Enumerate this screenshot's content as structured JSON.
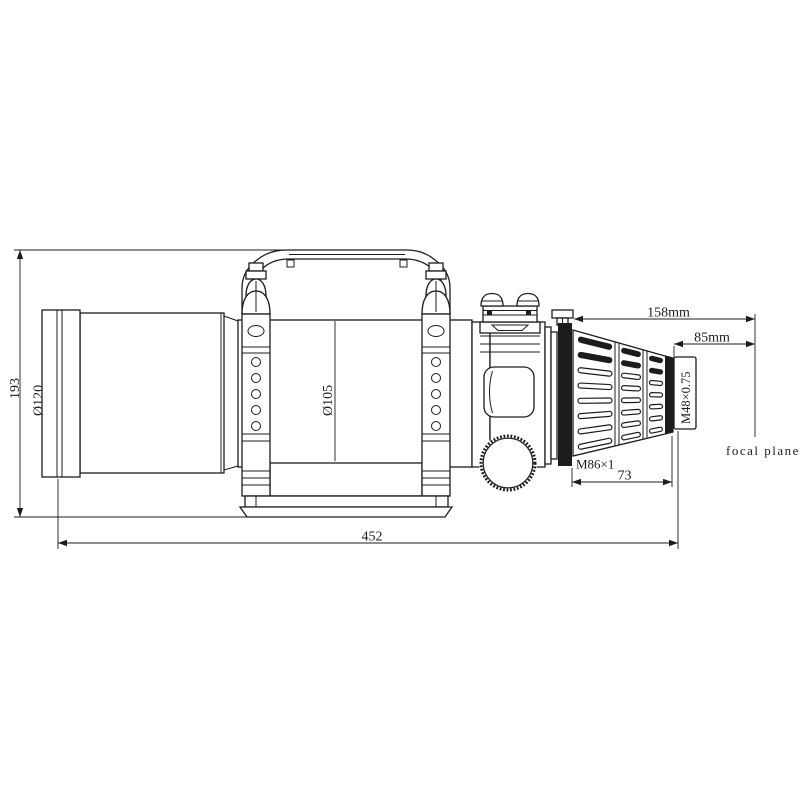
{
  "colors": {
    "line": "#1c1c1c",
    "background": "#ffffff"
  },
  "labels": {
    "overall_height": "193",
    "overall_length": "452",
    "front_cell_diameter": "Ø120",
    "tube_diameter": "Ø105",
    "flange_to_focal_plane": "158mm",
    "m48_to_focal_plane": "85mm",
    "drawtube_length": "73",
    "rear_thread": "M86×1",
    "camera_thread": "M48×0.75",
    "focal_plane": "focal plane"
  }
}
